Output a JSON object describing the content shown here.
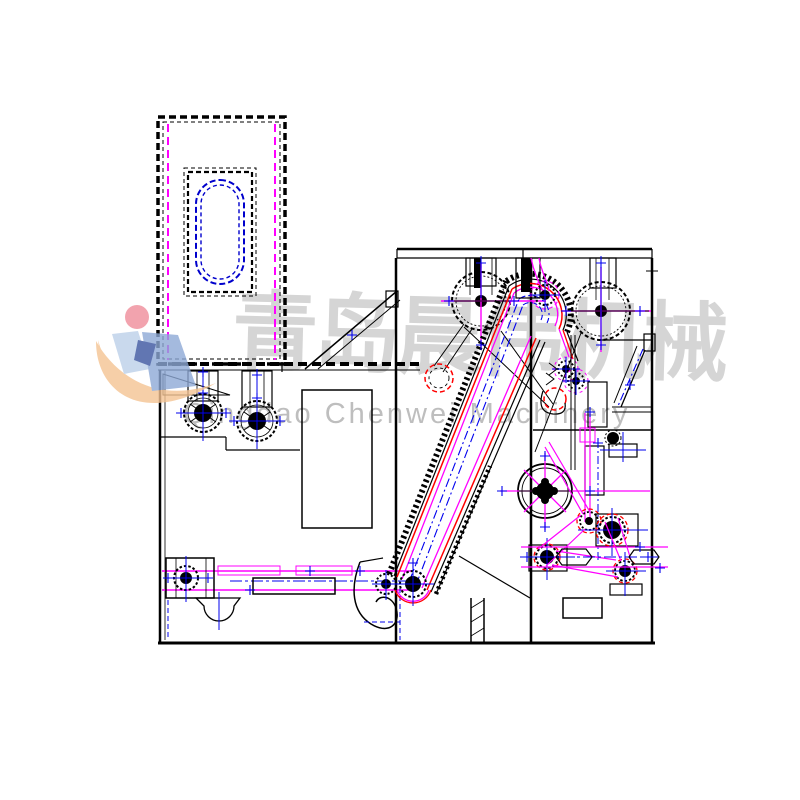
{
  "page": {
    "background": "#ffffff",
    "kind": "CAD line drawing, side elevation of a fiber-opening / carding machine line"
  },
  "watermark": {
    "chinese_text": "青岛晨伟机械",
    "english_text": "Qingdao Chenwei Machinery"
  },
  "colors": {
    "bg": "#ffffff",
    "outline": "#000000",
    "magenta": "#ff00ff",
    "blue": "#0000ee",
    "red": "#ff0000",
    "stadium": "#0000cc",
    "wm-text": "#a9a9a9",
    "logo-dot": "#ef8d9b",
    "logo-swoosh": "#f5c493",
    "logo-light": "#bcd0e9",
    "logo-mid": "#8ea9d6",
    "logo-dark": "#3a549f"
  },
  "components": [
    "feed-hopper-chute",
    "hopper-inspection-window",
    "feed-beater-rollers",
    "left-machine-frame",
    "bottom-lattice-conveyor",
    "inclined-spiked-lattice-conveyor",
    "toothed-cylinder-left",
    "toothed-cylinder-right",
    "stripper-roller-pair",
    "handwheel",
    "gear-belt-drive-train",
    "output-duct",
    "discharge-chute"
  ]
}
